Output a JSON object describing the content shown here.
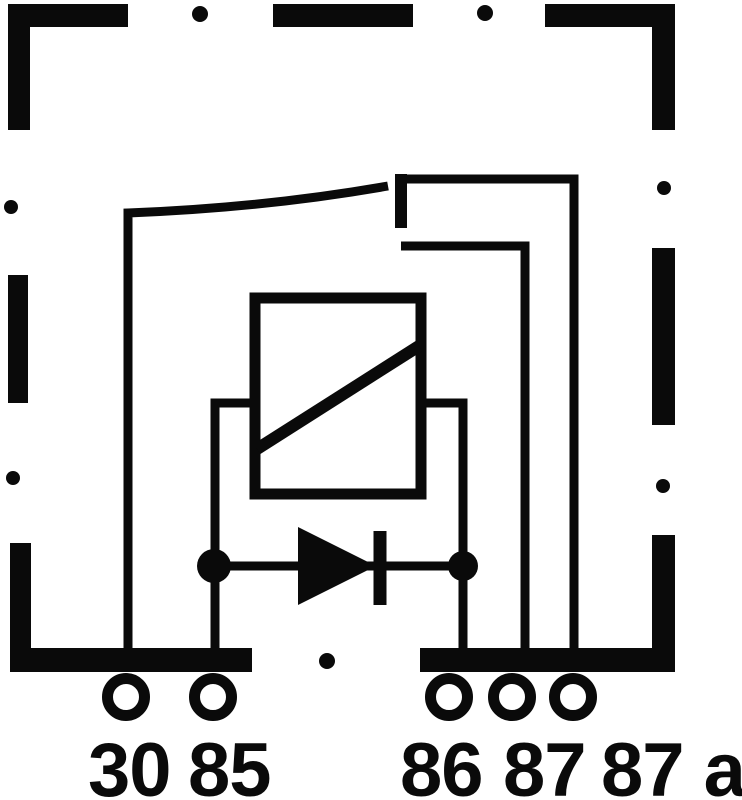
{
  "diagram": {
    "kind": "relay-wiring-schematic",
    "colors": {
      "ink": "#0a0a0a",
      "background": "#ffffff"
    },
    "terminals": [
      {
        "id": "30",
        "label": "30"
      },
      {
        "id": "85",
        "label": "85"
      },
      {
        "id": "86",
        "label": "86"
      },
      {
        "id": "87",
        "label": "87"
      },
      {
        "id": "87a",
        "label": "87 a"
      }
    ],
    "components": [
      "housing-dashed-outline",
      "relay-coil",
      "coil-suppression-diode",
      "changeover-switch-contact"
    ]
  }
}
